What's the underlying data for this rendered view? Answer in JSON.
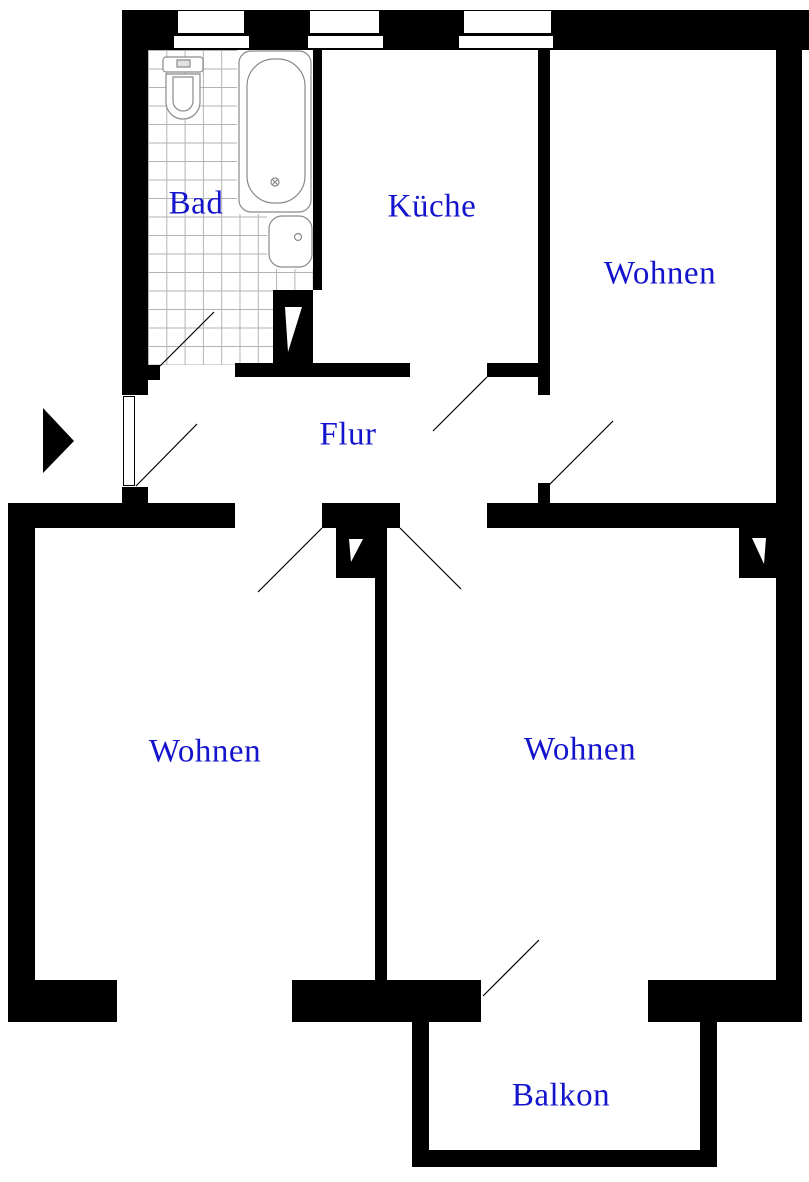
{
  "title": "Wohnung Grundriss",
  "colors": {
    "wall": "#000000",
    "label": "#1414cc",
    "tile_line": "#b3b3b3",
    "fixture": "#8a8a8a"
  },
  "rooms": {
    "bad": {
      "label": "Bad"
    },
    "kueche": {
      "label": "Küche"
    },
    "wohnen_top": {
      "label": "Wohnen"
    },
    "flur": {
      "label": "Flur"
    },
    "wohnen_left": {
      "label": "Wohnen"
    },
    "wohnen_right": {
      "label": "Wohnen"
    },
    "balkon": {
      "label": "Balkon"
    }
  },
  "icons": [
    "bathtub-icon",
    "toilet-icon",
    "sink-icon",
    "entrance-arrow-icon",
    "chimney-shaft-icon",
    "door-swing-icon",
    "window-icon"
  ]
}
